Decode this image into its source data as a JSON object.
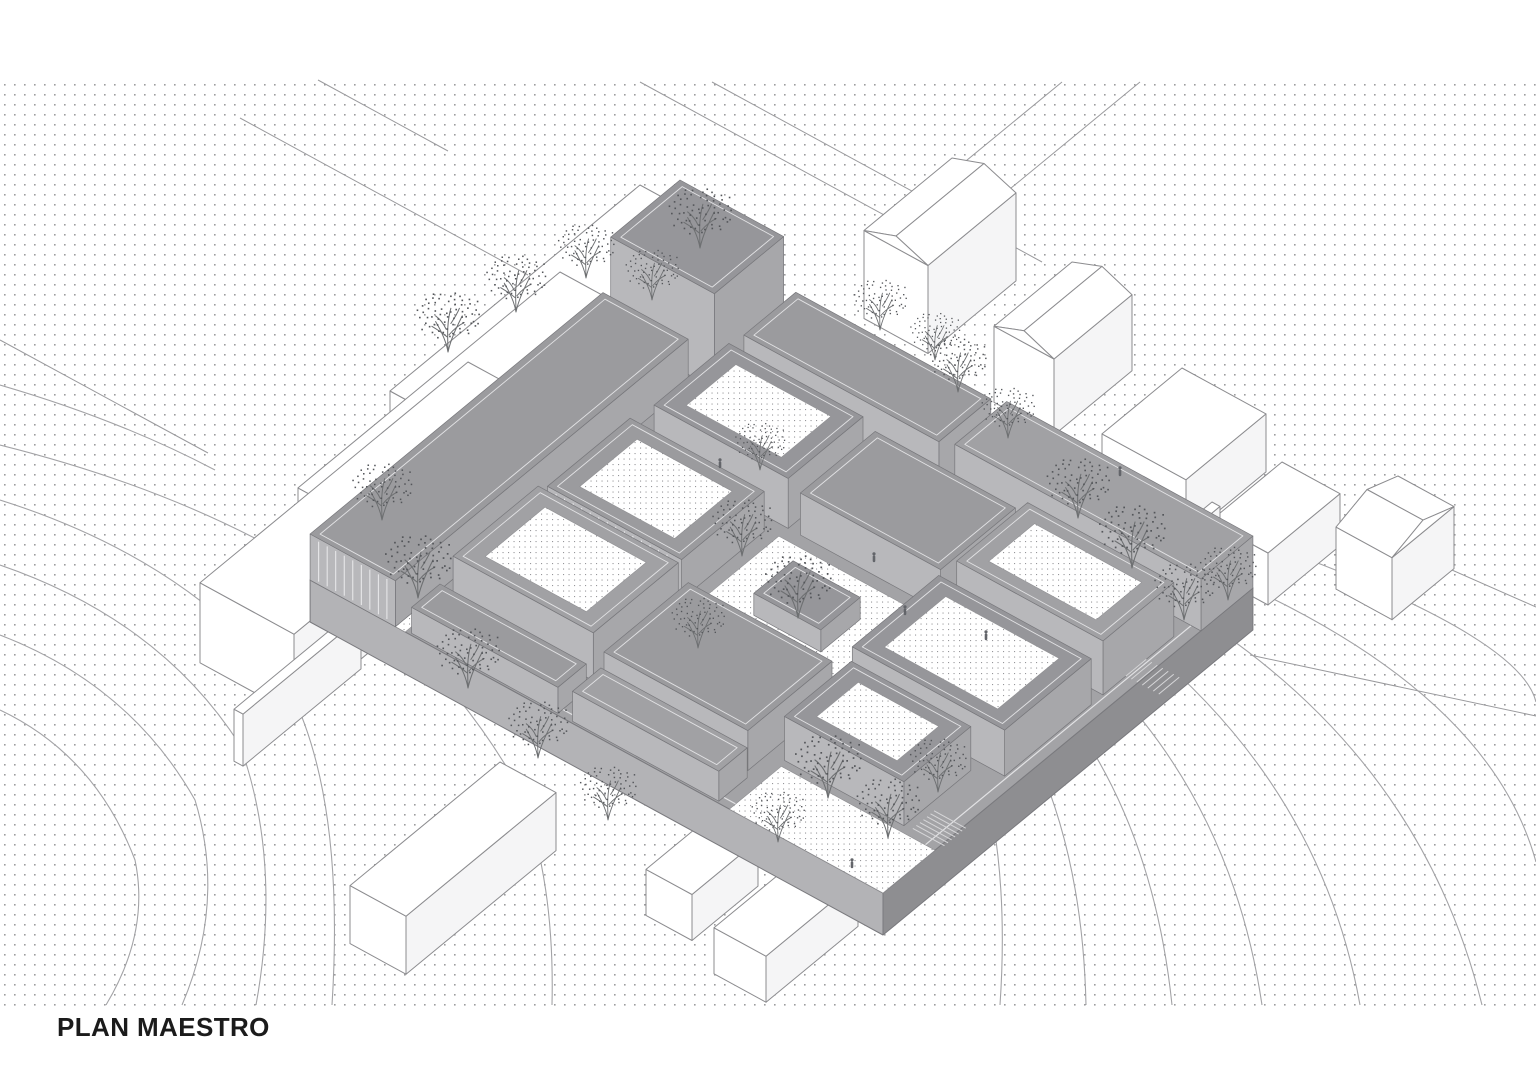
{
  "title": {
    "label": "PLAN MAESTRO"
  },
  "drawing": {
    "colors": {
      "background": "#ffffff",
      "dot": "#9c9c9e",
      "dot_fine": "#96969a",
      "roof_shades": [
        "#9b9b9e",
        "#96969a",
        "#a1a1a4"
      ],
      "wall_sw": "#b8b8bb",
      "wall_se": "#a7a7aa",
      "block_stroke": "#77777b",
      "parapet": "#e2e2e4",
      "plinth_top": "#a3a3a6",
      "plinth_sw": "#b3b3b6",
      "plinth_se": "#8e8e91",
      "plinth_stroke": "#7a7a7e",
      "context_fill": "#ffffff",
      "context_side": "#f5f5f6",
      "context_stroke": "#8c8c8f",
      "street": "#9a9a9d",
      "contour": "#a3a3a6",
      "stair": "#d7d7d9",
      "tree_branch": "#6e7072",
      "tree_leaf": "#54565a",
      "figure": "#63656a",
      "title_text": "#1b1b1b"
    },
    "dot_field": {
      "y0": 79,
      "y1": 1006
    },
    "iso": {
      "ox": 680,
      "oy": 275,
      "ax": 1.219,
      "ay": 0.666,
      "bx": 0.787,
      "by": 0.649,
      "size": 470,
      "depth": 42,
      "a_slope": 0.546,
      "b_slope": 0.824
    },
    "streets": [
      [
        640,
        82,
        952,
        252
      ],
      [
        712,
        82,
        1042,
        262
      ],
      [
        240,
        118,
        528,
        275
      ],
      [
        318,
        80,
        448,
        151
      ],
      [
        0,
        340,
        208,
        453
      ],
      [
        1140,
        82,
        943,
        244
      ],
      [
        1062,
        82,
        888,
        225
      ],
      [
        1368,
        533,
        1536,
        607
      ],
      [
        1250,
        655,
        1536,
        716
      ]
    ],
    "contours": [
      "M0 445 Q240 505 390 625 Q470 700 520 790 Q555 880 552 1005",
      "M0 500 Q190 560 290 690 Q345 800 332 1005",
      "M0 565 Q160 620 240 745 Q282 862 256 1005",
      "M0 635 Q130 685 195 800 Q226 902 182 1005",
      "M0 710 Q95 755 135 860 Q150 932 106 1005",
      "M0 385 Q120 420 215 470",
      "M962 712 Q1012 830 1000 1005",
      "M1005 700 Q1082 822 1086 1005",
      "M1048 688 Q1152 812 1172 1005",
      "M1095 668 Q1232 802 1262 1005",
      "M1145 645 Q1322 792 1360 1005",
      "M1200 618 Q1422 762 1482 1005",
      "M1255 590 Q1492 702 1536 862",
      "M1310 560 Q1522 642 1536 702"
    ],
    "context_buildings": [
      {
        "x": 640,
        "y": 185,
        "a": 72,
        "b": 250,
        "h": 92
      },
      {
        "x": 560,
        "y": 272,
        "a": 80,
        "b": 262,
        "h": 86
      },
      {
        "x": 468,
        "y": 362,
        "a": 94,
        "b": 268,
        "h": 80
      },
      {
        "x": 352,
        "y": 612,
        "a": 9,
        "b": 118,
        "h": 52
      },
      {
        "x": 952,
        "y": 158,
        "a": 64,
        "b": 88,
        "h": 88,
        "gable": "B"
      },
      {
        "x": 1072,
        "y": 262,
        "a": 60,
        "b": 78,
        "h": 76,
        "gable": "B"
      },
      {
        "x": 1182,
        "y": 368,
        "a": 84,
        "b": 80,
        "h": 58
      },
      {
        "x": 1282,
        "y": 462,
        "a": 58,
        "b": 72,
        "h": 52
      },
      {
        "x": 1398,
        "y": 476,
        "a": 56,
        "b": 62,
        "h": 62,
        "gable": "A"
      },
      {
        "x": 1212,
        "y": 502,
        "a": 8,
        "b": 46,
        "h": 30
      },
      {
        "x": 500,
        "y": 762,
        "a": 56,
        "b": 150,
        "h": 58
      },
      {
        "x": 712,
        "y": 815,
        "a": 46,
        "b": 66,
        "h": 46
      },
      {
        "x": 806,
        "y": 852,
        "a": 52,
        "b": 92,
        "h": 46
      }
    ],
    "blocks": [
      {
        "u": 0,
        "v": 0,
        "du": 85,
        "dv": 88,
        "h": 95,
        "shade": 1
      },
      {
        "u": 95,
        "v": 0,
        "du": 160,
        "dv": 66,
        "h": 46,
        "shade": 0
      },
      {
        "u": 268,
        "v": 0,
        "du": 202,
        "dv": 66,
        "h": 52,
        "shade": 2
      },
      {
        "u": 0,
        "v": 98,
        "du": 70,
        "dv": 372,
        "h": 46,
        "shade": 0,
        "slats": true
      },
      {
        "u": 95,
        "v": 85,
        "du": 110,
        "dv": 95,
        "h": 50,
        "shade": 1,
        "court": true
      },
      {
        "u": 215,
        "v": 85,
        "du": 115,
        "dv": 95,
        "h": 42,
        "shade": 0
      },
      {
        "u": 340,
        "v": 85,
        "du": 120,
        "dv": 90,
        "h": 54,
        "shade": 2,
        "court": true
      },
      {
        "u": 85,
        "v": 195,
        "du": 110,
        "dv": 105,
        "h": 40,
        "shade": 0,
        "court": true,
        "slats": true
      },
      {
        "u": 335,
        "v": 190,
        "du": 125,
        "dv": 110,
        "h": 46,
        "shade": 1,
        "court": true
      },
      {
        "u": 85,
        "v": 312,
        "du": 115,
        "dv": 108,
        "h": 48,
        "shade": 2,
        "court": true
      },
      {
        "u": 212,
        "v": 318,
        "du": 118,
        "dv": 107,
        "h": 40,
        "shade": 0
      },
      {
        "u": 342,
        "v": 312,
        "du": 98,
        "dv": 85,
        "h": 44,
        "shade": 1,
        "court": true
      },
      {
        "u": 82,
        "v": 432,
        "du": 120,
        "dv": 36,
        "h": 26,
        "shade": 0
      },
      {
        "u": 214,
        "v": 432,
        "du": 120,
        "dv": 36,
        "h": 30,
        "shade": 2
      },
      {
        "u": 240,
        "v": 228,
        "du": 55,
        "dv": 50,
        "h": 22,
        "shade": 1
      }
    ],
    "courts": [
      {
        "u": 205,
        "v": 192,
        "du": 125,
        "dv": 112
      },
      {
        "u": 344,
        "v": 404,
        "du": 126,
        "dv": 66
      },
      {
        "u": 0,
        "v": 432,
        "du": 78,
        "dv": 38
      }
    ],
    "stairs": [
      {
        "u": 460,
        "v": 120,
        "n": 7,
        "w": 26,
        "dir": "B"
      },
      {
        "u": 446,
        "v": 368,
        "n": 7,
        "w": 26,
        "dir": "A"
      }
    ],
    "trees": {
      "branches": "M0 0 C-2 -12 -7 -22 -13 -32 M0 0 C3 -14 9 -26 15 -38 M0 0 C0 -12 -2 -28 3 -46 M1 -18 C6 -24 11 -28 17 -31 M-1 -16 C-7 -21 -12 -24 -17 -27 M3 -30 C7 -36 10 -41 12 -46 M-2 -24 C-5 -31 -9 -35 -13 -38",
      "dots": 64,
      "positions": [
        [
          448,
          352,
          0.95
        ],
        [
          516,
          312,
          0.9
        ],
        [
          586,
          278,
          0.85
        ],
        [
          652,
          300,
          0.8
        ],
        [
          700,
          248,
          0.95
        ],
        [
          382,
          520,
          0.9
        ],
        [
          418,
          598,
          1.0
        ],
        [
          468,
          688,
          0.95
        ],
        [
          538,
          758,
          0.9
        ],
        [
          608,
          820,
          0.85
        ],
        [
          742,
          556,
          0.9
        ],
        [
          798,
          618,
          1.0
        ],
        [
          698,
          648,
          0.8
        ],
        [
          760,
          470,
          0.75
        ],
        [
          1078,
          518,
          0.95
        ],
        [
          1132,
          568,
          1.0
        ],
        [
          1184,
          620,
          0.9
        ],
        [
          958,
          392,
          0.85
        ],
        [
          1008,
          438,
          0.8
        ],
        [
          1228,
          600,
          0.85
        ],
        [
          828,
          798,
          1.0
        ],
        [
          888,
          838,
          0.95
        ],
        [
          938,
          792,
          0.85
        ],
        [
          778,
          842,
          0.8
        ],
        [
          880,
          330,
          0.8
        ],
        [
          935,
          360,
          0.75
        ]
      ]
    },
    "figures": [
      [
        874,
        562
      ],
      [
        720,
        468
      ],
      [
        986,
        640
      ],
      [
        852,
        868
      ],
      [
        1120,
        476
      ],
      [
        905,
        615
      ]
    ]
  }
}
